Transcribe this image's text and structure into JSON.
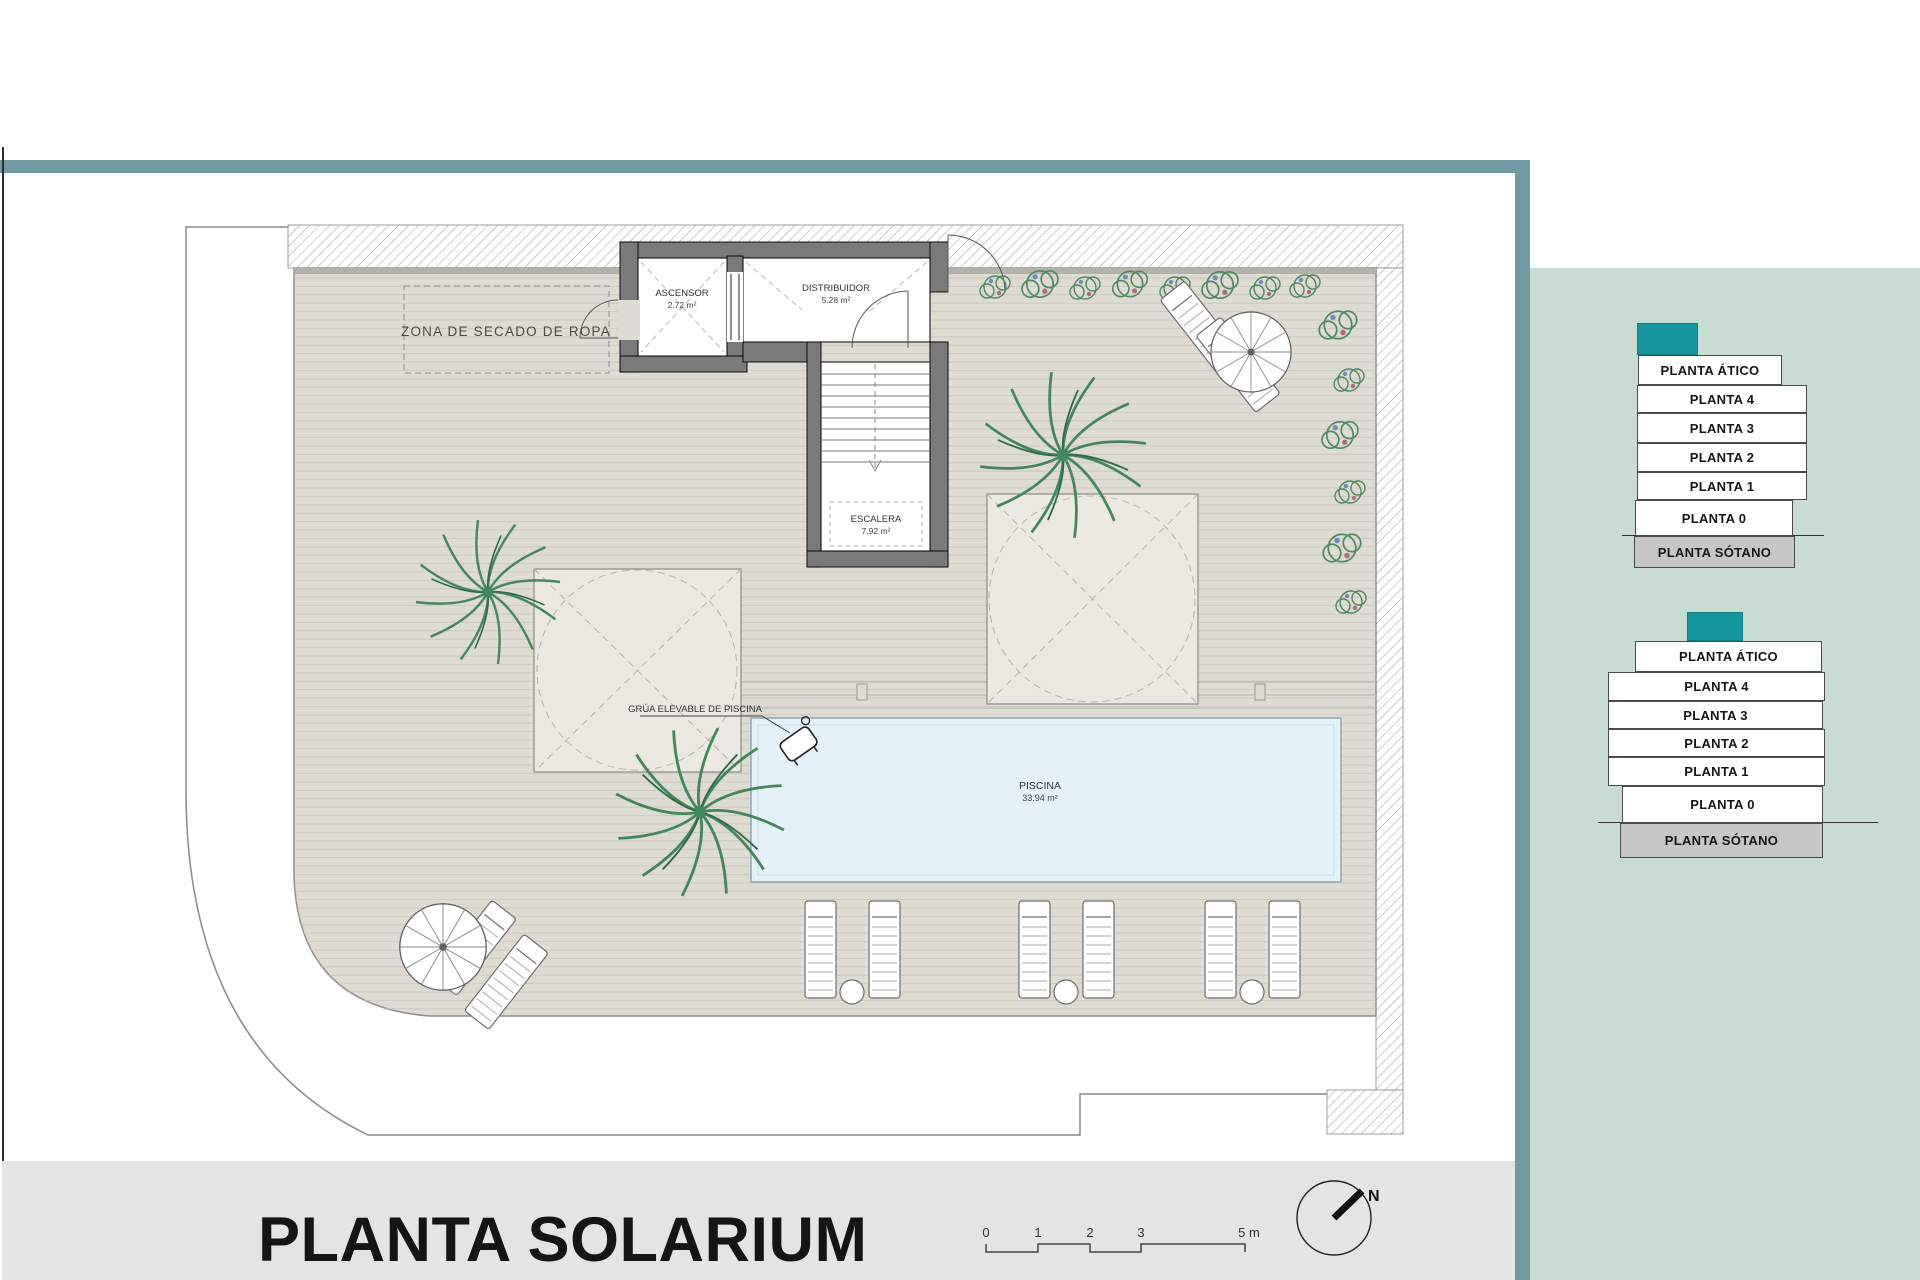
{
  "plan": {
    "zona_label": "ZONA DE SECADO DE ROPA",
    "rooms": {
      "ascensor": {
        "name": "ASCENSOR",
        "area": "2.72 m²"
      },
      "distribuidor": {
        "name": "DISTRIBUIDOR",
        "area": "5.28 m²"
      },
      "escalera": {
        "name": "ESCALERA",
        "area": "7.92 m²"
      }
    },
    "pool": {
      "name": "PISCINA",
      "area": "33.94 m²"
    },
    "grua_label": "GRÚA ELEVABLE DE PISCINA"
  },
  "stacks": {
    "first": {
      "levels": [
        "PLANTA ÁTICO",
        "PLANTA 4",
        "PLANTA 3",
        "PLANTA 2",
        "PLANTA 1",
        "PLANTA 0",
        "PLANTA SÓTANO"
      ]
    },
    "second": {
      "levels": [
        "PLANTA ÁTICO",
        "PLANTA 4",
        "PLANTA 3",
        "PLANTA 2",
        "PLANTA 1",
        "PLANTA 0",
        "PLANTA SÓTANO"
      ]
    }
  },
  "footer": {
    "title": "PLANTA SOLARIUM",
    "scale_ticks": [
      "0",
      "1",
      "2",
      "3",
      "5 m"
    ],
    "north_label": "N"
  },
  "colors": {
    "accent_teal": "#15969e",
    "frame_teal": "#7399a3",
    "panel_sage": "#c9dcd4",
    "pool_blue": "#e4f1f8",
    "sotano_gray": "#c6c6c6",
    "deck_beige": "#dedbd3"
  }
}
